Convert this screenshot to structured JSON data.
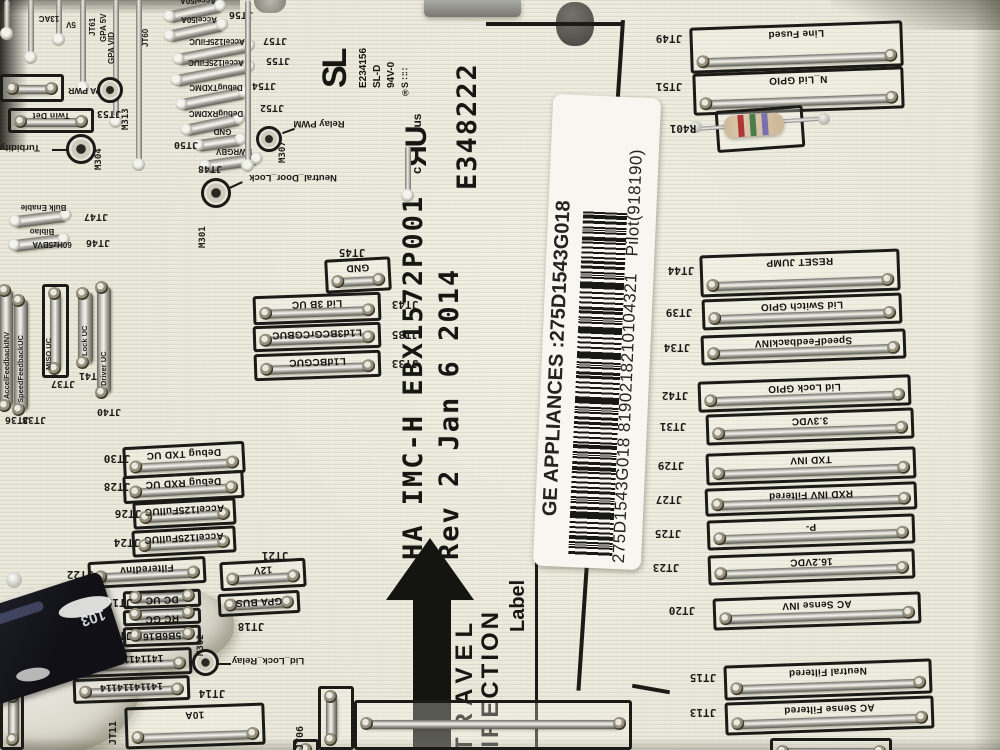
{
  "board_text": {
    "model_line": "HA IMC-H EBX1572P001",
    "rev_line": "Rev 2 Jan 6 2014",
    "ul_file_number": "E348222",
    "cert_mark": {
      "c": "c",
      "logo": "ЯU",
      "us": "us",
      "reg": "®"
    },
    "travel_word1": "TRAVEL",
    "travel_word2": "DIRECTION",
    "label_callout": "Label",
    "mfr_block": {
      "logo": "SL",
      "cert_number": "E234156",
      "type_code": "SL-D",
      "flammability": "94V-0",
      "date_code": "S ∷∷"
    }
  },
  "sticker": {
    "line1": "GE APPLIANCES :275D1543G018",
    "line2": "275D1543G018 8190218210104321",
    "line2_suffix": "Pilot(918190)"
  },
  "right_connectors": [
    {
      "ref": "JT49",
      "label": "Line Fused"
    },
    {
      "ref": "JT51",
      "label": "N_Lid GPIO"
    },
    {
      "ref": "JT44",
      "label": "RESET JUMP"
    },
    {
      "ref": "JT39",
      "label": "Lid Switch GPIO"
    },
    {
      "ref": "JT34",
      "label": "SpeedFeedbackINV"
    },
    {
      "ref": "JT42",
      "label": "Lid Lock GPIO"
    },
    {
      "ref": "JT31",
      "label": "3.3VDC"
    },
    {
      "ref": "JT29",
      "label": "TXD INV"
    },
    {
      "ref": "JT27",
      "label": "RXD INV Filtered"
    },
    {
      "ref": "JT25",
      "label": "P-"
    },
    {
      "ref": "JT23",
      "label": "16.2VDC"
    },
    {
      "ref": "JT20",
      "label": "AC Sense INV"
    },
    {
      "ref": "JT15",
      "label": "Neutral Filtered"
    },
    {
      "ref": "JT13",
      "label": "AC Sense Filtered"
    }
  ],
  "center_connectors": [
    {
      "ref": "JT45",
      "label": "GND"
    },
    {
      "ref": "JT43",
      "label": "Lid 3B UC"
    },
    {
      "ref": "JT35",
      "label": "L1d3BCGrCGBUC"
    },
    {
      "ref": "JT33",
      "label": "L1dBCGUC"
    },
    {
      "ref": "JT30",
      "label": "Debug TXD UC"
    },
    {
      "ref": "JT28",
      "label": "Debug RXD UC"
    },
    {
      "ref": "JT26",
      "label": "Accel125FullUC"
    },
    {
      "ref": "JT24",
      "label": "Accel125FullUC"
    },
    {
      "ref": "JT22",
      "label": "FilteredInv"
    },
    {
      "ref": "JT21",
      "label": "12V"
    },
    {
      "ref": "JT18",
      "label": "GPA BUS"
    },
    {
      "ref": "JT19",
      "label": "DC UC"
    },
    {
      "ref": "",
      "label": "RC GC"
    },
    {
      "ref": "JT17",
      "label": "5B6B16"
    },
    {
      "ref": "",
      "label": "1411411411"
    },
    {
      "ref": "JT14",
      "label": "14114114114"
    },
    {
      "ref": "JT11",
      "label": "10A"
    },
    {
      "ref": "JT06",
      "label": ""
    }
  ],
  "jumpers": [
    {
      "ref": "JT56",
      "label": "Accel50A"
    },
    {
      "ref": "JT57",
      "label": "Accel50A"
    },
    {
      "ref": "JT55",
      "label": "Accel125FilUC"
    },
    {
      "ref": "JT54",
      "label": "Accel125FilUC"
    },
    {
      "ref": "JT52",
      "label": "DebugTXDMC"
    },
    {
      "ref": "",
      "label": "DebugRXDMC"
    },
    {
      "ref": "JT50",
      "label": "GND"
    },
    {
      "ref": "JT48",
      "label": "PWRGBV"
    },
    {
      "ref": "JT47",
      "label": "Bulk Enable"
    },
    {
      "ref": "JT46",
      "label": "Biblao"
    },
    {
      "ref": "",
      "label": "60Hz5BVA"
    }
  ],
  "left_vertical_connectors": [
    {
      "ref": "JT36",
      "label": "AccelFeedbackINV"
    },
    {
      "ref": "JT38",
      "label": "SpeedFeedbackUC"
    },
    {
      "ref": "JT37",
      "label": "MISO UC"
    },
    {
      "ref": "JT41",
      "label": "Lock UC"
    },
    {
      "ref": "JT40",
      "label": "Driver UC"
    }
  ],
  "top_left": {
    "pad_label1": "GPA PWR",
    "pad_label2": "Twin Det",
    "pad_ref2": "JT53",
    "wire_labels": [
      "13AC",
      "5V",
      "JT61",
      "GPA 5V",
      "GPA VID",
      "JT60"
    ]
  },
  "relays": [
    {
      "ref": "M313",
      "label": ""
    },
    {
      "ref": "M304",
      "label": "Turbidity Enable"
    },
    {
      "ref": "M307",
      "label": "Relay PWM"
    },
    {
      "ref": "M301",
      "label": "Neutral_Door_Lock"
    },
    {
      "ref": "M302",
      "label": "Lid_Lock_Relay"
    }
  ],
  "components": {
    "resistor_ref": "R401",
    "glue_marking": "103"
  },
  "colors": {
    "board": "#e8e6d7",
    "silkscreen": "#181815",
    "sticker": "#f7f6f1",
    "metal": "#d2d2cb",
    "resistor_body": "#cdb998",
    "band1": "#b23535",
    "band2": "#4a7d4a",
    "band3": "#7a6fb0"
  }
}
